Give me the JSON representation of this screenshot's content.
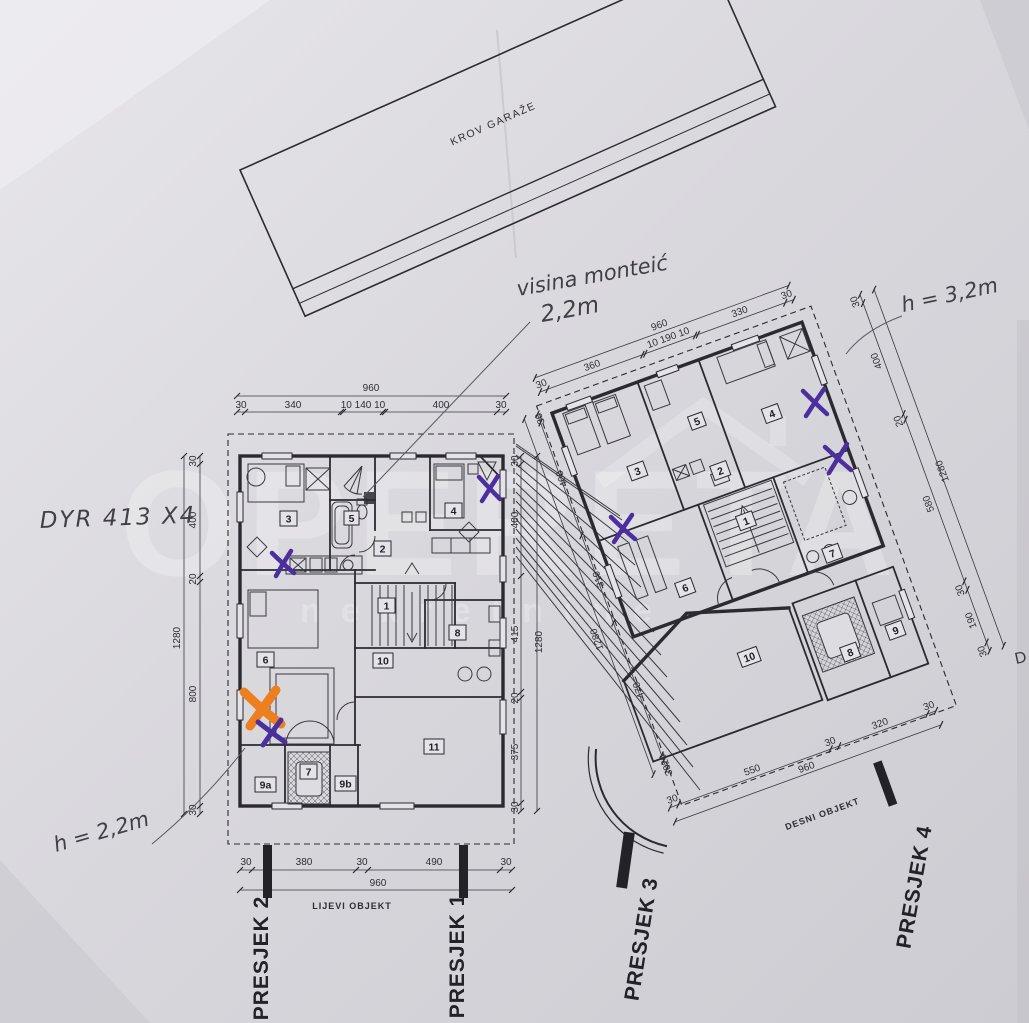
{
  "garage": {
    "label": "KROV GARAŽE"
  },
  "handwritten": {
    "attic_height_note": "visina monteić",
    "attic_height_value": "2,2m",
    "height_note_right": "h = 3,2m",
    "height_note_left": "h = 2,2m",
    "code_note": "DYR 413 X4"
  },
  "watermark": {
    "brand": "OPERETA",
    "subtitle": "nekretnine"
  },
  "left_plan": {
    "object_label": "LIJEVI OBJEKT",
    "rooms": {
      "r1": "1",
      "r2": "2",
      "r3": "3",
      "r4": "4",
      "r5": "5",
      "r6": "6",
      "r7": "7",
      "r8": "8",
      "r9a": "9a",
      "r9b": "9b",
      "r10": "10",
      "r11": "11"
    },
    "dims": {
      "top": {
        "total": "960",
        "segments": [
          "30",
          "340",
          "10 140 10",
          "400",
          "30"
        ]
      },
      "left": {
        "total": "1280",
        "segments": [
          "30",
          "400",
          "20",
          "800",
          "30"
        ]
      },
      "right": {
        "total": "1280",
        "segments": [
          "30",
          "400",
          "415",
          "20",
          "375",
          "30"
        ]
      },
      "bottom": {
        "total": "960",
        "segments": [
          "30",
          "380",
          "30",
          "490",
          "30"
        ]
      }
    },
    "sections": {
      "s1": "PRESJEK 1",
      "s2": "PRESJEK 2"
    }
  },
  "right_plan": {
    "object_label": "DESNI OBJEKT",
    "rooms": {
      "r1": "1",
      "r2": "2",
      "r3": "3",
      "r4": "4",
      "r5": "5",
      "r6": "6",
      "r7": "7",
      "r8": "8",
      "r9": "9",
      "r10": "10"
    },
    "dims": {
      "top": {
        "total": "960",
        "segments": [
          "30",
          "360",
          "10 190 10",
          "330",
          "30"
        ]
      },
      "right": {
        "total": "1280",
        "segments": [
          "30",
          "400",
          "20",
          "580",
          "30",
          "190",
          "30"
        ]
      },
      "left": {
        "total": "1280",
        "segments": [
          "30",
          "400",
          "310",
          "470",
          "20",
          "30"
        ]
      },
      "bottom": {
        "total": "960",
        "segments": [
          "30",
          "550",
          "30",
          "320",
          "30"
        ]
      }
    },
    "sections": {
      "s3": "PRESJEK 3",
      "s4": "PRESJEK 4"
    }
  },
  "fragments": {
    "right_edge_letter": "D"
  },
  "colors": {
    "marker_purple": "#4b2f9e",
    "marker_orange": "#ee7f1e",
    "ink": "#2e2d33",
    "paper": "#d9d8dd"
  }
}
